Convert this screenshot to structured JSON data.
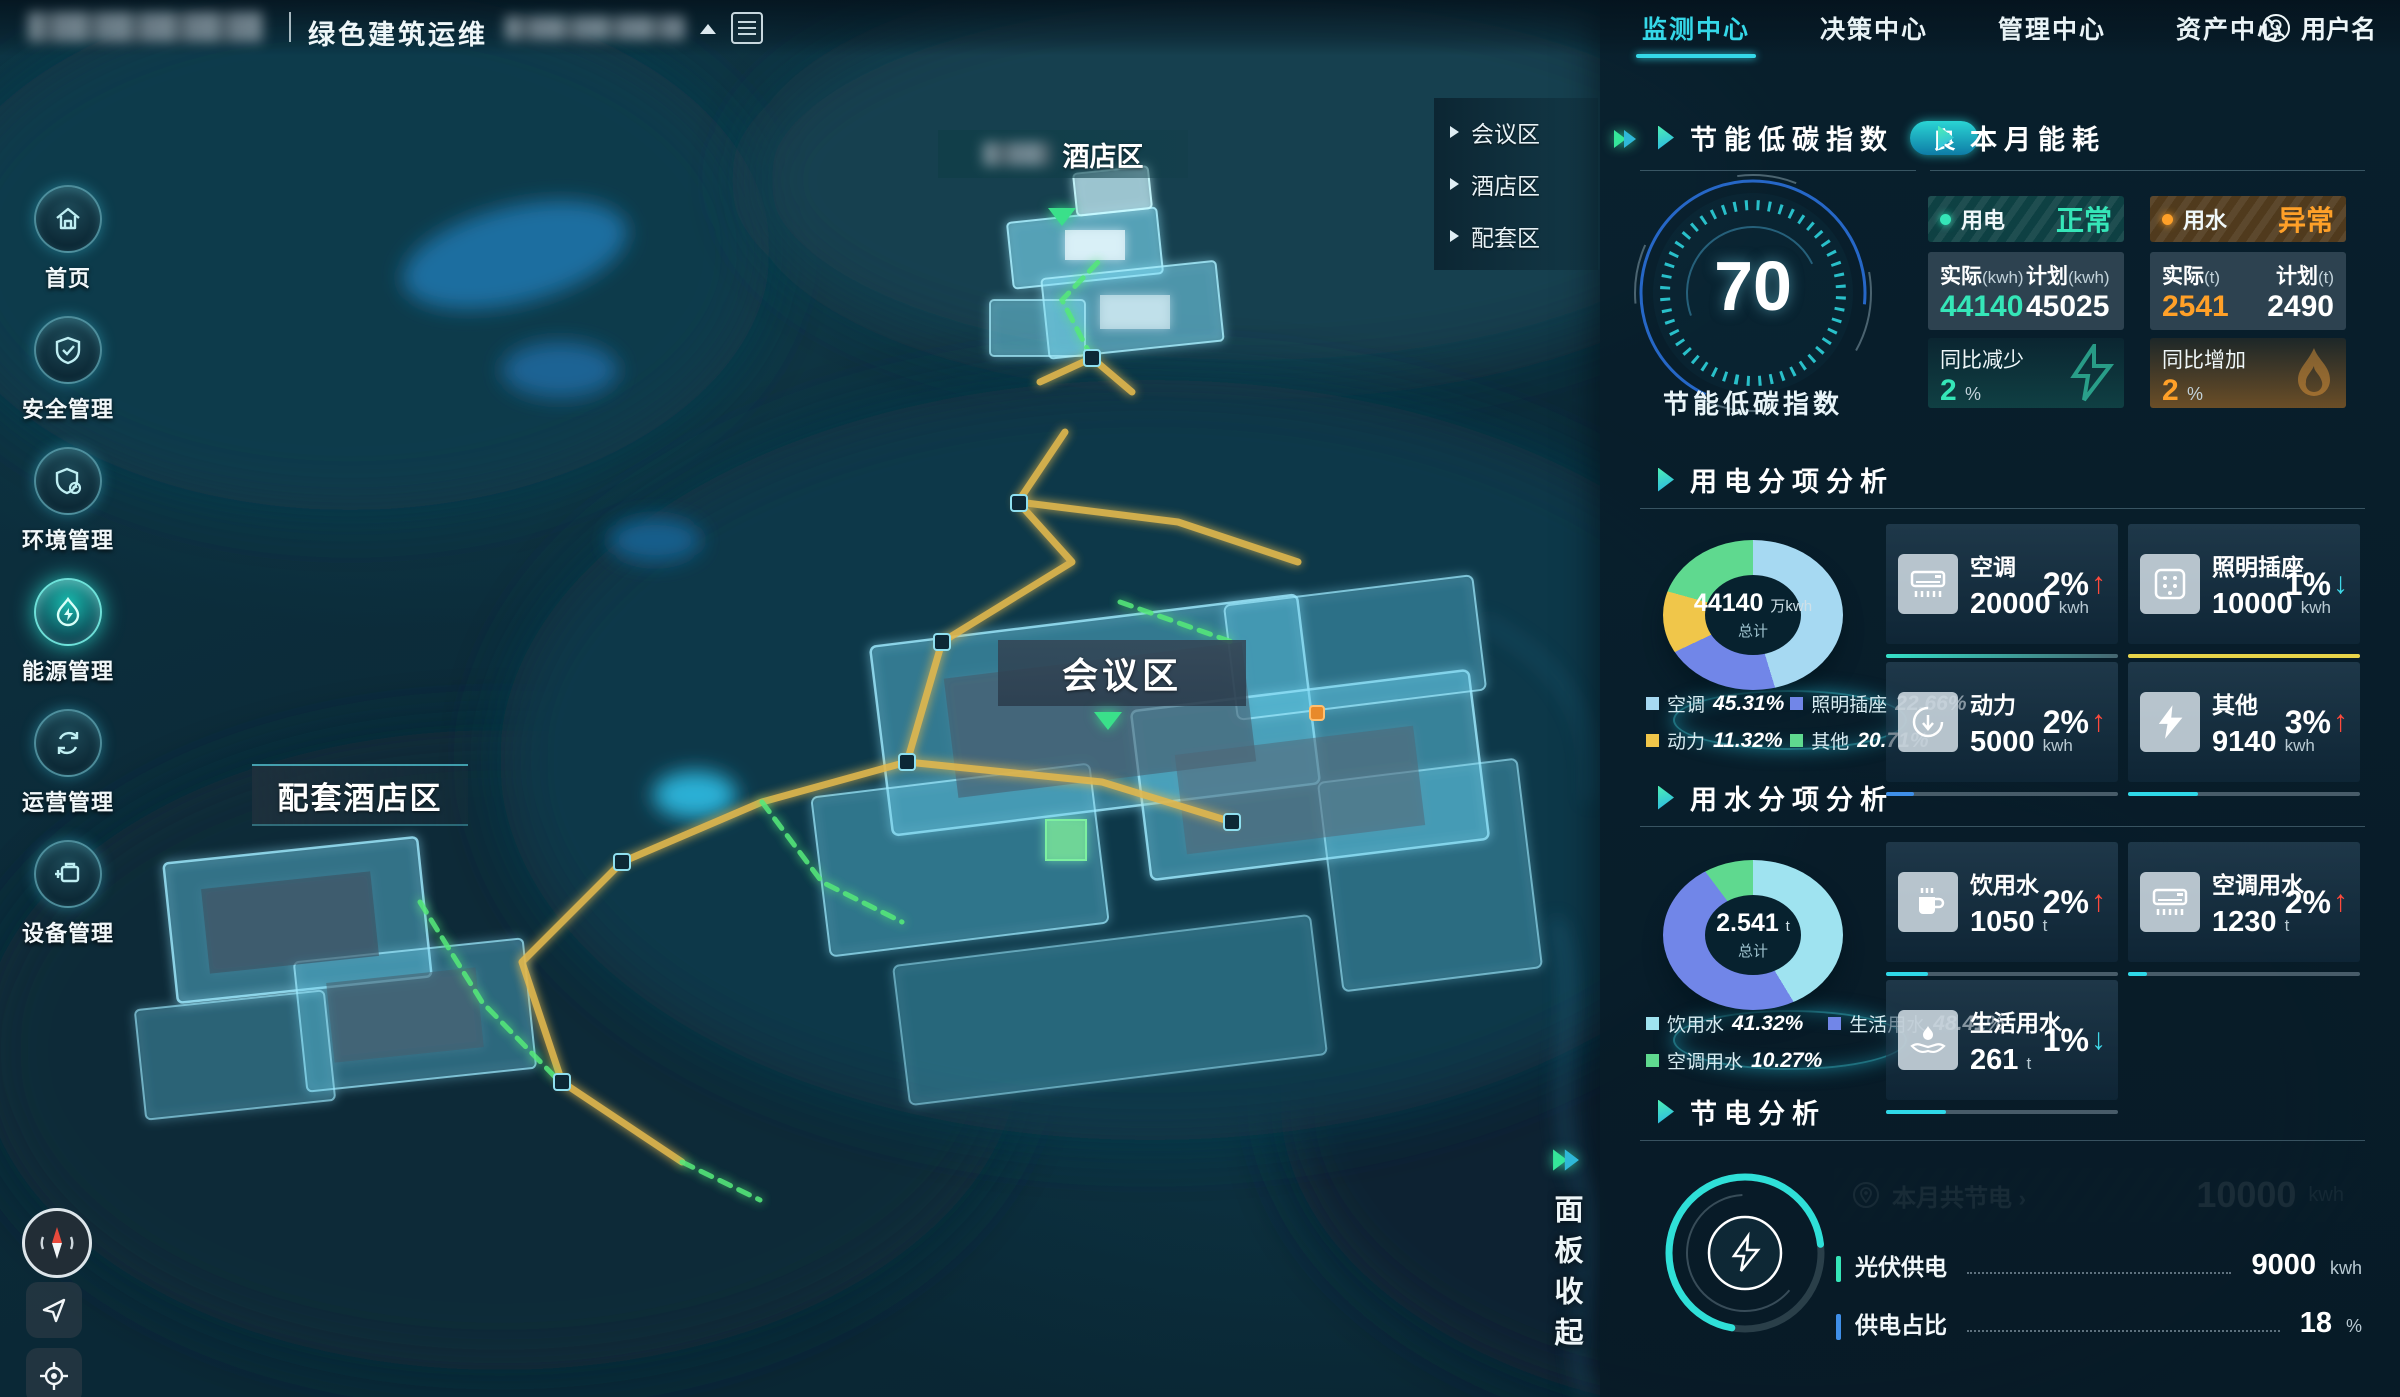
{
  "top_bar": {
    "title": "绿色建筑运维",
    "nav_items": [
      {
        "label": "监测中心",
        "active": true
      },
      {
        "label": "决策中心",
        "active": false
      },
      {
        "label": "管理中心",
        "active": false
      },
      {
        "label": "资产中心",
        "active": false
      }
    ],
    "user_label": "用户名"
  },
  "sidebar": {
    "items": [
      {
        "label": "首页"
      },
      {
        "label": "安全管理"
      },
      {
        "label": "环境管理"
      },
      {
        "label": "能源管理",
        "active": true
      },
      {
        "label": "运营管理"
      },
      {
        "label": "设备管理"
      }
    ]
  },
  "map": {
    "region_menu": {
      "items": [
        {
          "label": "会议区"
        },
        {
          "label": "酒店区"
        },
        {
          "label": "配套区"
        }
      ]
    },
    "labels": {
      "hotel_suffix": "酒店区",
      "conference": "会议区",
      "annex": "配套酒店区"
    },
    "collapse_label": "面板收起"
  },
  "panel": {
    "index_card": {
      "title": "节能低碳指数",
      "badge": "良",
      "score": "70",
      "caption": "节能低碳指数"
    },
    "energy": {
      "title": "本月能耗",
      "electric": {
        "name": "用电",
        "status": "正常",
        "actual_label": "实际",
        "actual_unit": "(kwh)",
        "actual_value": "44140",
        "plan_label": "计划",
        "plan_unit": "(kwh)",
        "plan_value": "45025",
        "trend_label": "同比减少",
        "trend_value": "2",
        "trend_unit": "%",
        "status_color": "#35e6b8"
      },
      "water": {
        "name": "用水",
        "status": "异常",
        "actual_label": "实际",
        "actual_unit": "(t)",
        "actual_value": "2541",
        "plan_label": "计划",
        "plan_unit": "(t)",
        "plan_value": "2490",
        "trend_label": "同比增加",
        "trend_value": "2",
        "trend_unit": "%",
        "status_color": "#ffa028"
      }
    },
    "power_analysis": {
      "title": "用电分项分析",
      "donut": {
        "type": "donut",
        "center_value": "44140",
        "center_unit": "万kwh",
        "center_caption": "总计",
        "legend": [
          {
            "label": "空调",
            "percent": "45.31%",
            "color": "#a6d9f2"
          },
          {
            "label": "照明插座",
            "percent": "22.66%",
            "color": "#7186e8"
          },
          {
            "label": "动力",
            "percent": "11.32%",
            "color": "#f0c64a"
          },
          {
            "label": "其他",
            "percent": "20.71%",
            "color": "#5fd98f"
          }
        ]
      },
      "cards": [
        {
          "label": "空调",
          "value": "20000",
          "unit": "kwh",
          "delta": "2%",
          "direction": "up"
        },
        {
          "label": "照明插座",
          "value": "10000",
          "unit": "kwh",
          "delta": "1%",
          "direction": "down"
        },
        {
          "label": "动力",
          "value": "5000",
          "unit": "kwh",
          "delta": "2%",
          "direction": "up"
        },
        {
          "label": "其他",
          "value": "9140",
          "unit": "kwh",
          "delta": "3%",
          "direction": "up"
        }
      ]
    },
    "water_analysis": {
      "title": "用水分项分析",
      "donut": {
        "type": "donut",
        "center_value": "2.541",
        "center_unit": "t",
        "center_caption": "总计",
        "legend": [
          {
            "label": "饮用水",
            "percent": "41.32%",
            "color": "#9fe3f0"
          },
          {
            "label": "生活用水",
            "percent": "48.41%",
            "color": "#7186e8"
          },
          {
            "label": "空调用水",
            "percent": "10.27%",
            "color": "#5fd98f"
          }
        ]
      },
      "cards": [
        {
          "label": "饮用水",
          "value": "1050",
          "unit": "t",
          "delta": "2%",
          "direction": "up"
        },
        {
          "label": "空调用水",
          "value": "1230",
          "unit": "t",
          "delta": "2%",
          "direction": "up"
        },
        {
          "label": "生活用水",
          "value": "261",
          "unit": "t",
          "delta": "1%",
          "direction": "down"
        }
      ]
    },
    "saving": {
      "title": "节电分析",
      "total_label": "本月共节电",
      "total_chevron": "›",
      "total_value": "10000",
      "total_unit": "kwh",
      "rows": [
        {
          "label": "光伏供电",
          "value": "9000",
          "unit": "kwh"
        },
        {
          "label": "供电占比",
          "value": "18",
          "unit": "%"
        }
      ]
    },
    "accent_colors": {
      "cyan": "#35d8e8",
      "green": "#35e6b8",
      "orange": "#ffa028",
      "red": "#ff4a3c",
      "yellow": "#f0c64a"
    }
  }
}
